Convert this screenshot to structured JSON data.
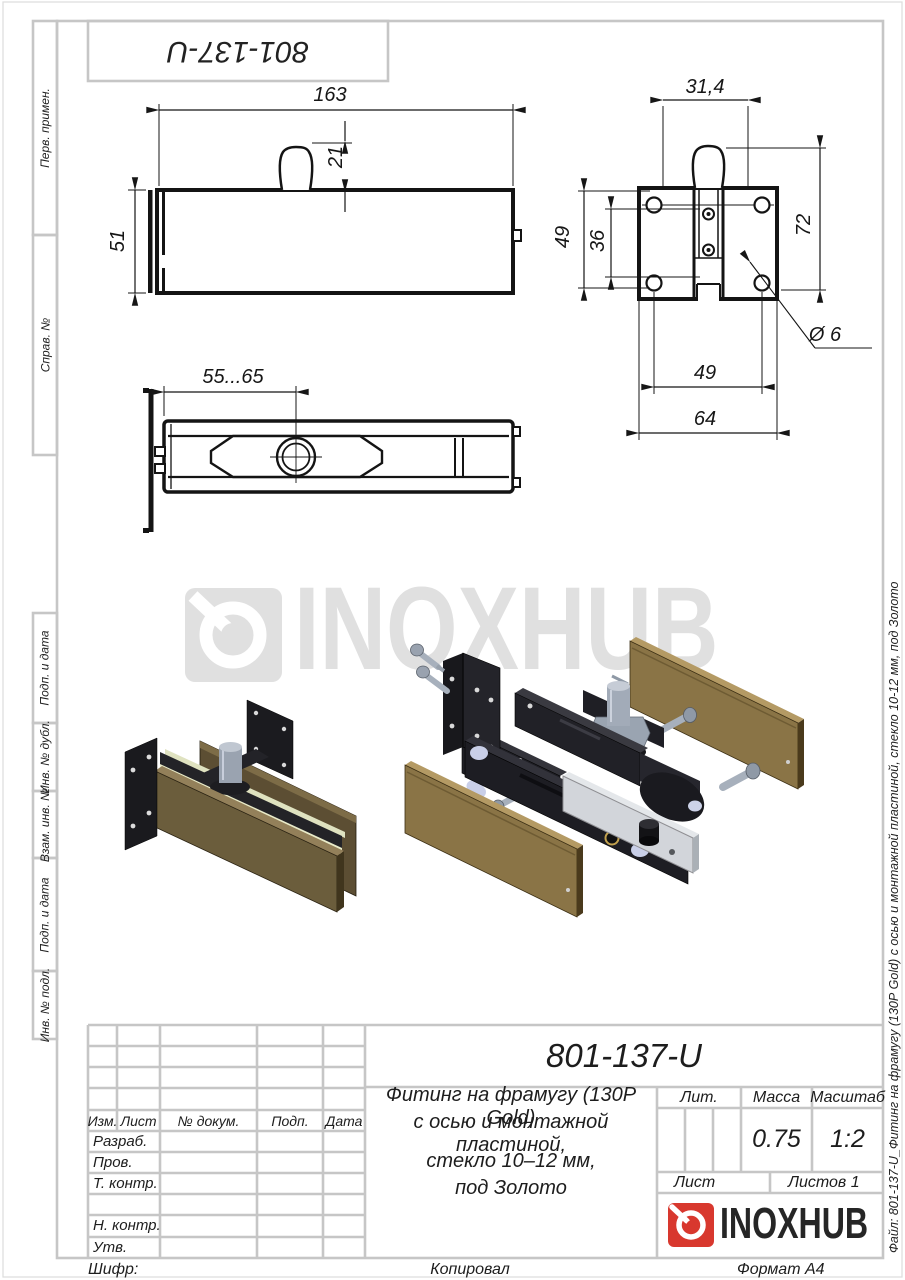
{
  "frame": {
    "stamp": "801-137-U",
    "left_labels": [
      "Перв. примен.",
      "Справ. №",
      "Подп. и дата",
      "Инв. № дубл.",
      "Взам. инв. №",
      "Подп. и дата",
      "Инв. № подл."
    ],
    "file_note": "Файл: 801-137-U_Фитинг на фрамугу (130Р Gold) с осью и монтажной пластиной, стекло 10-12 мм, под Золото"
  },
  "footer": {
    "cipher_label": "Шифр:",
    "copied_label": "Копировал",
    "format_label": "Формат А4"
  },
  "drawing": {
    "watermark": "INOXHUB",
    "dimensions": {
      "front_length": "163",
      "front_pin_height": "21",
      "front_height": "51",
      "plate_pin_width": "31,4",
      "plate_holes_v": "49",
      "plate_axis_v": "36",
      "plate_total_h": "72",
      "plate_hole_dia": "Ø 6",
      "plate_holes_h": "49",
      "plate_width": "64",
      "top_offset": "55...65"
    }
  },
  "title_block": {
    "designation": "801-137-U",
    "name_line1": "Фитинг на фрамугу (130Р Gold)",
    "name_line2": "с осью и монтажной пластиной,",
    "name_line3": "стекло 10–12 мм,",
    "name_line4": "под Золото",
    "lit_label": "Лит.",
    "mass_label": "Масса",
    "scale_label": "Масштаб",
    "mass_value": "0.75",
    "scale_value": "1:2",
    "sheet_label": "Лист",
    "sheets_label": "Листов 1",
    "header_cols": [
      "Изм.",
      "Лист",
      "№ докум.",
      "Подп.",
      "Дата"
    ],
    "sig_rows": [
      "Разраб.",
      "Пров.",
      "Т. контр.",
      "Н. контр.",
      "Утв."
    ],
    "logo_text": "INOXHUB"
  },
  "colors": {
    "accent_red": "#d8382e",
    "gold": "#8a7446",
    "watermark_gray": "#e0e0e0",
    "frame_gray": "#c6c6c6"
  }
}
